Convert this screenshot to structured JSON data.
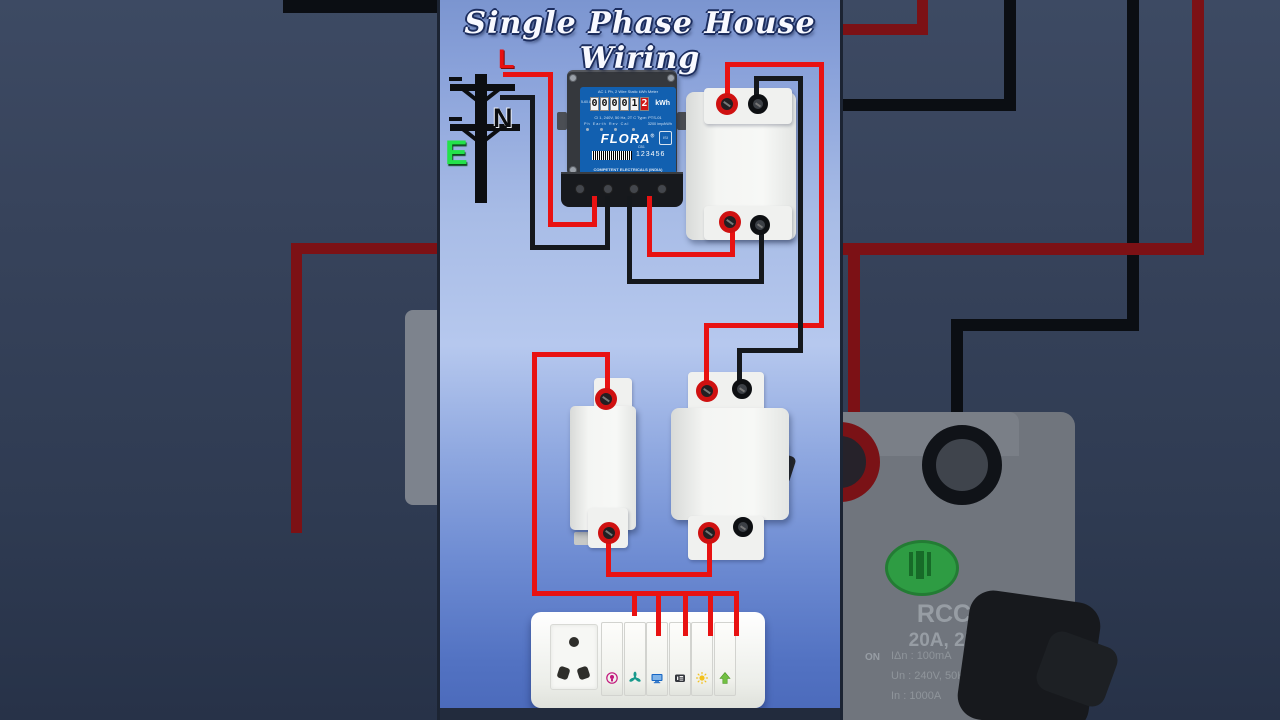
{
  "title": "Single Phase House Wiring",
  "supply": {
    "line": "L",
    "neutral": "N",
    "earth": "E"
  },
  "meter": {
    "header": "AC 1 Ph, 2 Wire Static kWh Meter",
    "reading": [
      "0",
      "0",
      "0",
      "0",
      "1",
      "2"
    ],
    "unit": "kWh",
    "current_range": "5-60 A",
    "spec_line": "Cl 1, 240V, 50 Hz, 2T C Type: PTS-01",
    "indicators": "Ph  Earth  Rev      Cal",
    "imp_rate": "3200 imp/kWh",
    "isi": "ISI",
    "brand": "FLORA",
    "brand_reg": "®",
    "sub_brand": "CB1",
    "serial": "123456",
    "maker_line1": "COMPETENT ELECTRICALS (INDIA)",
    "maker_line2": "New Delhi-34"
  },
  "dp_mcb": {
    "brand_letter": "S",
    "brand": "STANDARD",
    "pole": "DP",
    "toggle": "I-ON",
    "model": "25MSCDPP032",
    "rating": "C 32",
    "breaking": "10000",
    "energy_class": "3",
    "terminal_nums": "1 3\n2 4"
  },
  "sp_mcb": {
    "brand": "MDHI",
    "rating": "C10"
  },
  "rccb": {
    "name": "RCCB",
    "rating": "20A, 2P",
    "on": "ON",
    "off": "OFF",
    "sens": "IΔn : 100mA",
    "volt": "Un : 240V, 50Hz~",
    "current": "In : 1000A",
    "inc": "Inc : 10000A",
    "standard": "IS : 12640-1",
    "brand": "DEVCO"
  },
  "socket": {
    "switch_icons": [
      "bulb-point",
      "fan",
      "television",
      "ac-socket",
      "light-sun",
      "arrow-up"
    ]
  },
  "colors": {
    "line_wire": "#e81212",
    "neutral_wire": "#15181c",
    "earth_label": "#23e24a",
    "line_label": "#e81111",
    "mcb_toggle_blue": "#2f83d6",
    "meter_face_blue": "#1260b0",
    "digit_last_bg": "#d11616",
    "rccb_brand_red": "#e21212",
    "indicator_green": "#2e9c43",
    "bg_wire_red": "#7c1115",
    "bg_wire_black": "#0b0e13"
  }
}
